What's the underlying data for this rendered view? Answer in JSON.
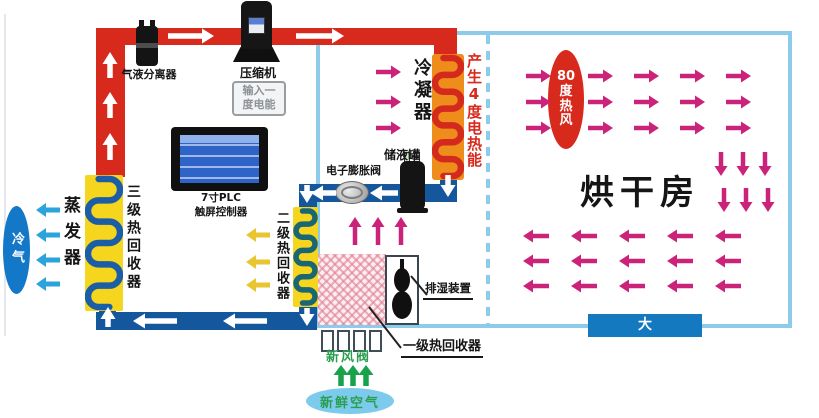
{
  "diagram": {
    "labels": {
      "separator": "气液分离器",
      "compressor": "压缩机",
      "condenser": "冷凝器",
      "heat_note": "产生4度电热能",
      "receiver": "储液罐",
      "expansion_valve": "电子膨胀阀",
      "stage3_recovery": "三级热回收器",
      "evaporator": "蒸发器",
      "cold_air": "冷气",
      "stage2_recovery": "二级热回收器",
      "stage1_recovery": "一级热回收器",
      "dehumidifier": "排湿装置",
      "fresh_air_valve": "新风阀",
      "fresh_air": "新鲜空气",
      "drying_room": "烘干房",
      "door": "大门"
    },
    "badges": {
      "compressor_input_lines": [
        "输入一",
        "度电能"
      ],
      "hot_air_lines": [
        "80",
        "度",
        "热",
        "风"
      ],
      "plc_lines": [
        "7寸PLC",
        "触屏控制器"
      ]
    },
    "colors": {
      "hot_pipe_red": "#d8291d",
      "cold_pipe_blue": "#15579d",
      "wall_light_blue": "#8ccbe9",
      "hot_air_magenta": "#cb2379",
      "coil_block_yellow": "#f6d51e",
      "condenser_orange": "#ee8d1c",
      "fresh_air_green": "#18a24c",
      "cold_air_cyan": "#2aa4da",
      "recovery_yellow": "#e9c62f",
      "door_blue": "#1479be"
    }
  }
}
